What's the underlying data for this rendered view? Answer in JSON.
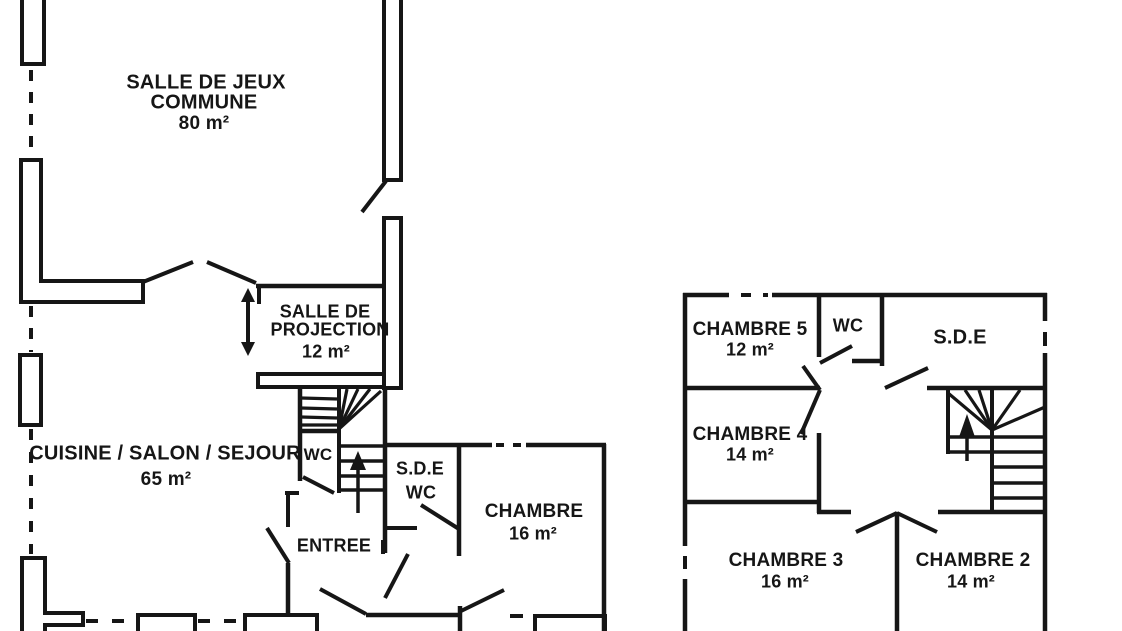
{
  "document_title": "Floor plan",
  "colors": {
    "wall": "#161616",
    "background": "#ffffff"
  },
  "ground_floor": {
    "salle_de_jeux": {
      "line1": "SALLE DE JEUX",
      "line2": "COMMUNE",
      "area": "80 m²"
    },
    "salle_de_projection": {
      "line1": "SALLE DE",
      "line2": "PROJECTION",
      "area": "12 m²"
    },
    "cuisine_salon_sejour": {
      "line1": "CUISINE / SALON / SEJOUR",
      "area": "65 m²"
    },
    "wc": {
      "label": "WC"
    },
    "sde_wc": {
      "line1": "S.D.E",
      "line2": "WC"
    },
    "chambre": {
      "line1": "CHAMBRE",
      "area": "16 m²"
    },
    "entree": {
      "label": "ENTREE"
    }
  },
  "first_floor": {
    "chambre5": {
      "line1": "CHAMBRE 5",
      "area": "12 m²"
    },
    "wc": {
      "label": "WC"
    },
    "sde": {
      "label": "S.D.E"
    },
    "chambre4": {
      "line1": "CHAMBRE 4",
      "area": "14 m²"
    },
    "chambre3": {
      "line1": "CHAMBRE 3",
      "area": "16 m²"
    },
    "chambre2": {
      "line1": "CHAMBRE 2",
      "area": "14 m²"
    }
  }
}
